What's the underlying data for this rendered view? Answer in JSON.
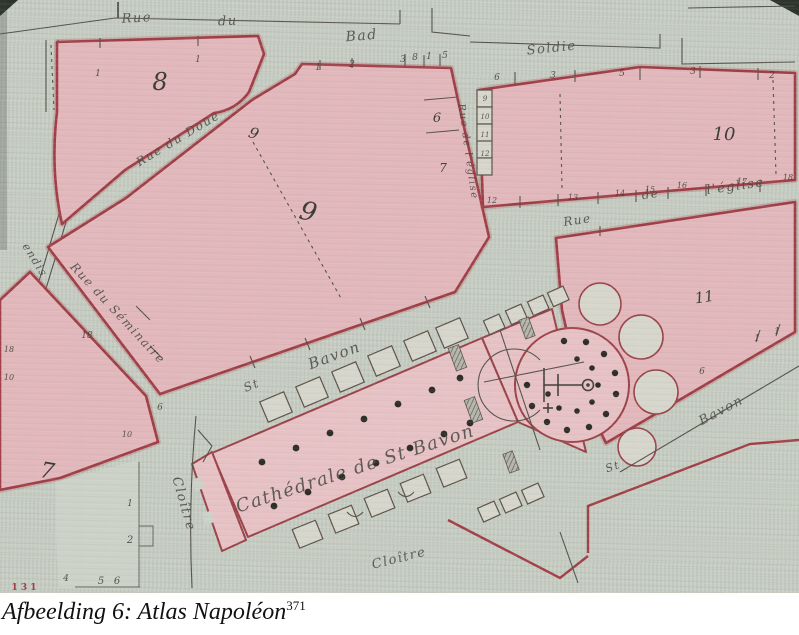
{
  "caption": {
    "text": "Afbeelding 6: Atlas Napoléon",
    "footnote": "371"
  },
  "map": {
    "colors": {
      "paper": "#c7cdc3",
      "block_fill": "#e2b8bc",
      "block_edge": "#a03e47",
      "ink": "#55534b"
    },
    "blocks": [
      "7",
      "8",
      "9",
      "10",
      "11"
    ],
    "streets": [
      "Rue du Bad",
      "Soldie",
      "Rue du Doue",
      "Rue du Séminaire",
      "Rue de l'église",
      "St Bavon",
      "Cloître"
    ],
    "landmark": "Cathédrale de St Bavon",
    "labels": [
      {
        "name": "street-label-rue-top",
        "text": "Rue",
        "x": 137,
        "y": 22,
        "rot": -3,
        "size": 13,
        "cls": "street"
      },
      {
        "name": "street-label-du-top",
        "text": "du",
        "x": 228,
        "y": 25,
        "rot": -3,
        "size": 13,
        "cls": "street"
      },
      {
        "name": "street-label-bad",
        "text": "Bad",
        "x": 362,
        "y": 40,
        "rot": -5,
        "size": 14,
        "cls": "street"
      },
      {
        "name": "street-label-soldie",
        "text": "Soldie",
        "x": 552,
        "y": 52,
        "rot": -6,
        "size": 13,
        "cls": "street"
      },
      {
        "name": "street-label-rue-du-doue",
        "text": "Rue du Doue",
        "x": 180,
        "y": 142,
        "rot": -31,
        "size": 12,
        "cls": "street"
      },
      {
        "name": "street-label-rue-du-seminaire",
        "text": "Rue du Séminaire",
        "x": 115,
        "y": 316,
        "rot": 47,
        "size": 12,
        "cls": "street"
      },
      {
        "name": "street-label-rue-eglise-1",
        "text": "Rue",
        "x": 578,
        "y": 224,
        "rot": -8,
        "size": 12,
        "cls": "street"
      },
      {
        "name": "street-label-rue-eglise-2",
        "text": "de",
        "x": 651,
        "y": 198,
        "rot": -8,
        "size": 12,
        "cls": "street"
      },
      {
        "name": "street-label-rue-eglise-3",
        "text": "l'église",
        "x": 736,
        "y": 190,
        "rot": -8,
        "size": 13,
        "cls": "street"
      },
      {
        "name": "street-label-rue-eglise-vertical",
        "text": "Rue de l'église",
        "x": 465,
        "y": 152,
        "rot": 82,
        "size": 10,
        "cls": "street"
      },
      {
        "name": "street-label-st",
        "text": "St",
        "x": 253,
        "y": 389,
        "rot": -22,
        "size": 12,
        "cls": "street"
      },
      {
        "name": "street-label-bavon",
        "text": "Bavon",
        "x": 336,
        "y": 360,
        "rot": -20,
        "size": 15,
        "cls": "street"
      },
      {
        "name": "cathedral-label",
        "text": "Cathédrale de St Bavon",
        "x": 357,
        "y": 474,
        "rot": -18,
        "size": 18,
        "cls": "street"
      },
      {
        "name": "street-label-cloitre-west",
        "text": "Cloître",
        "x": 180,
        "y": 505,
        "rot": 74,
        "size": 13,
        "cls": "street"
      },
      {
        "name": "street-label-cloitre-south",
        "text": "Cloître",
        "x": 400,
        "y": 562,
        "rot": -14,
        "size": 13,
        "cls": "street"
      },
      {
        "name": "street-label-st-2",
        "text": "St",
        "x": 614,
        "y": 470,
        "rot": -20,
        "size": 11,
        "cls": "street"
      },
      {
        "name": "street-label-bavon-2",
        "text": "Bavon",
        "x": 723,
        "y": 414,
        "rot": -28,
        "size": 13,
        "cls": "street"
      },
      {
        "name": "street-label-left-edge-partial",
        "text": "endis",
        "x": 32,
        "y": 262,
        "rot": 58,
        "size": 11,
        "cls": "street"
      },
      {
        "name": "block-number-8",
        "text": "8",
        "x": 160,
        "y": 90,
        "rot": 0,
        "size": 24,
        "cls": "num"
      },
      {
        "name": "block-number-9-small",
        "text": "9",
        "x": 252,
        "y": 138,
        "rot": 20,
        "size": 15,
        "cls": "num"
      },
      {
        "name": "block-number-9",
        "text": "9",
        "x": 306,
        "y": 220,
        "rot": 15,
        "size": 26,
        "cls": "num"
      },
      {
        "name": "block-number-10",
        "text": "10",
        "x": 724,
        "y": 140,
        "rot": 0,
        "size": 18,
        "cls": "num"
      },
      {
        "name": "block-number-11",
        "text": "11",
        "x": 705,
        "y": 302,
        "rot": -8,
        "size": 15,
        "cls": "num"
      },
      {
        "name": "block-number-7",
        "text": "7",
        "x": 46,
        "y": 478,
        "rot": 10,
        "size": 22,
        "cls": "num"
      },
      {
        "name": "parcel-number-6",
        "text": "6",
        "x": 437,
        "y": 122,
        "rot": 0,
        "size": 13,
        "cls": "num"
      },
      {
        "name": "parcel-number-7",
        "text": "7",
        "x": 443,
        "y": 172,
        "rot": 0,
        "size": 12,
        "cls": "num"
      },
      {
        "name": "parcel-number",
        "text": "1",
        "x": 98,
        "y": 76,
        "size": 9,
        "cls": "tiny num"
      },
      {
        "name": "parcel-number",
        "text": "1",
        "x": 198,
        "y": 62,
        "size": 9,
        "cls": "tiny num"
      },
      {
        "name": "parcel-number",
        "text": "1",
        "x": 318,
        "y": 70,
        "size": 9,
        "cls": "tiny num"
      },
      {
        "name": "parcel-number",
        "text": "2",
        "x": 352,
        "y": 67,
        "size": 9,
        "cls": "tiny num"
      },
      {
        "name": "parcel-number",
        "text": "3",
        "x": 403,
        "y": 62,
        "size": 9,
        "cls": "tiny num"
      },
      {
        "name": "parcel-number",
        "text": "8",
        "x": 415,
        "y": 60,
        "size": 9,
        "cls": "tiny num"
      },
      {
        "name": "parcel-number",
        "text": "1",
        "x": 429,
        "y": 59,
        "size": 9,
        "cls": "tiny num"
      },
      {
        "name": "parcel-number",
        "text": "5",
        "x": 445,
        "y": 58,
        "size": 9,
        "cls": "tiny num"
      },
      {
        "name": "parcel-number",
        "text": "6",
        "x": 497,
        "y": 80,
        "size": 9,
        "cls": "tiny num"
      },
      {
        "name": "parcel-number",
        "text": "3",
        "x": 553,
        "y": 78,
        "size": 9,
        "cls": "tiny num"
      },
      {
        "name": "parcel-number",
        "text": "5",
        "x": 622,
        "y": 76,
        "size": 9,
        "cls": "tiny num"
      },
      {
        "name": "parcel-number",
        "text": "3",
        "x": 693,
        "y": 74,
        "size": 9,
        "cls": "tiny num"
      },
      {
        "name": "parcel-number",
        "text": "2",
        "x": 772,
        "y": 78,
        "size": 9,
        "cls": "tiny num"
      },
      {
        "name": "parcel-number",
        "text": "12",
        "x": 492,
        "y": 203,
        "size": 8,
        "cls": "tiny num"
      },
      {
        "name": "parcel-number",
        "text": "13",
        "x": 573,
        "y": 200,
        "size": 8,
        "cls": "tiny num"
      },
      {
        "name": "parcel-number",
        "text": "14",
        "x": 620,
        "y": 196,
        "size": 8,
        "cls": "tiny num"
      },
      {
        "name": "parcel-number",
        "text": "15",
        "x": 650,
        "y": 192,
        "size": 8,
        "cls": "tiny num"
      },
      {
        "name": "parcel-number",
        "text": "16",
        "x": 682,
        "y": 188,
        "size": 8,
        "cls": "tiny num"
      },
      {
        "name": "parcel-number",
        "text": "17",
        "x": 742,
        "y": 184,
        "size": 8,
        "cls": "tiny num"
      },
      {
        "name": "parcel-number",
        "text": "18",
        "x": 788,
        "y": 180,
        "size": 8,
        "cls": "tiny num"
      },
      {
        "name": "parcel-number",
        "text": "18",
        "x": 87,
        "y": 338,
        "size": 9,
        "cls": "tiny num"
      },
      {
        "name": "parcel-number",
        "text": "6",
        "x": 160,
        "y": 410,
        "size": 9,
        "cls": "tiny num"
      },
      {
        "name": "parcel-number",
        "text": "10",
        "x": 127,
        "y": 437,
        "size": 8,
        "cls": "tiny num"
      },
      {
        "name": "parcel-number",
        "text": "1",
        "x": 130,
        "y": 506,
        "size": 9,
        "cls": "tiny num"
      },
      {
        "name": "parcel-number",
        "text": "2",
        "x": 130,
        "y": 543,
        "size": 10,
        "cls": "tiny num"
      },
      {
        "name": "parcel-number",
        "text": "4",
        "x": 66,
        "y": 581,
        "size": 9,
        "cls": "tiny num"
      },
      {
        "name": "parcel-number",
        "text": "5",
        "x": 101,
        "y": 584,
        "size": 10,
        "cls": "tiny num"
      },
      {
        "name": "parcel-number",
        "text": "6",
        "x": 117,
        "y": 584,
        "size": 10,
        "cls": "tiny num"
      },
      {
        "name": "parcel-number",
        "text": "1",
        "x": 757,
        "y": 341,
        "size": 9,
        "cls": "tiny num"
      },
      {
        "name": "parcel-number",
        "text": "1",
        "x": 777,
        "y": 334,
        "size": 9,
        "cls": "tiny num"
      },
      {
        "name": "parcel-number",
        "text": "6",
        "x": 702,
        "y": 374,
        "size": 9,
        "cls": "tiny num"
      },
      {
        "name": "parcel-number",
        "text": "9",
        "x": 485,
        "y": 101,
        "size": 7,
        "cls": "tiny num"
      },
      {
        "name": "parcel-number",
        "text": "10",
        "x": 485,
        "y": 119,
        "size": 7,
        "cls": "tiny num"
      },
      {
        "name": "parcel-number",
        "text": "11",
        "x": 485,
        "y": 137,
        "size": 7,
        "cls": "tiny num"
      },
      {
        "name": "parcel-number",
        "text": "12",
        "x": 485,
        "y": 156,
        "size": 7,
        "cls": "tiny num"
      },
      {
        "name": "parcel-number",
        "text": "18",
        "x": 9,
        "y": 352,
        "size": 8,
        "cls": "tiny num"
      },
      {
        "name": "parcel-number",
        "text": "10",
        "x": 9,
        "y": 380,
        "size": 8,
        "cls": "tiny num"
      },
      {
        "name": "parcel-number-red",
        "text": "1 3 1",
        "x": 24,
        "y": 590,
        "size": 9,
        "cls": "rednum"
      }
    ]
  }
}
